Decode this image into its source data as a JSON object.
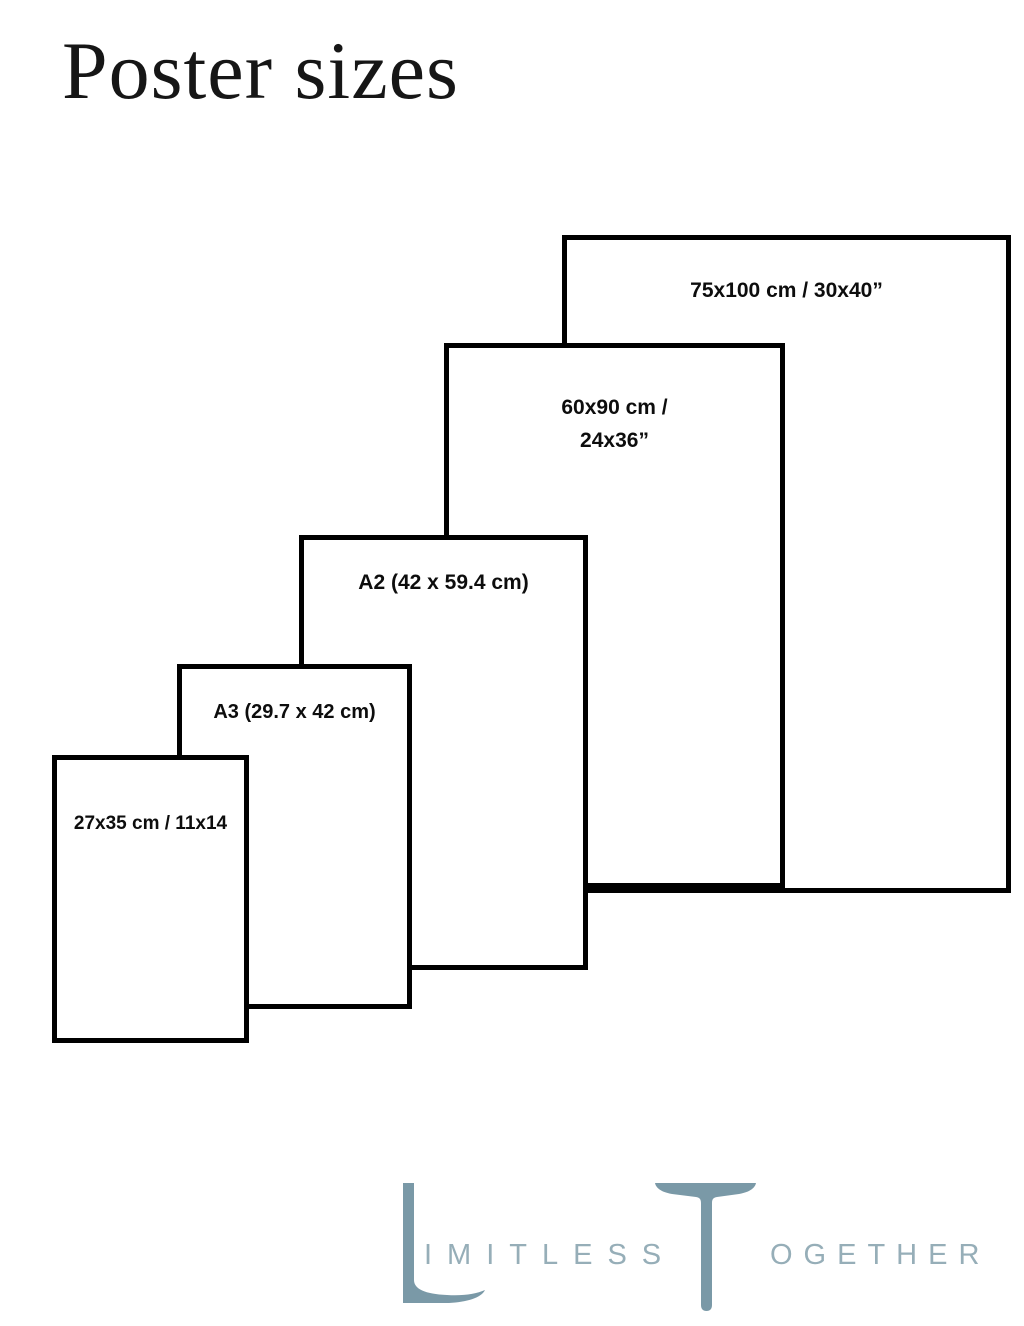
{
  "title": "Poster sizes",
  "posters": [
    {
      "name": "75x100",
      "label": "75x100 cm / 30x40”"
    },
    {
      "name": "60x90",
      "label_line1": "60x90 cm /",
      "label_line2": "24x36”"
    },
    {
      "name": "A2",
      "label": "A2 (42 x 59.4 cm)"
    },
    {
      "name": "A3",
      "label": "A3 (29.7 x 42 cm)"
    },
    {
      "name": "27x35",
      "label": "27x35 cm / 11x14"
    }
  ],
  "logo": {
    "word1_initial": "L",
    "word1_rest": "IMITLESS",
    "word2_initial": "T",
    "word2_rest": "OGETHER",
    "accent_color": "#7A99A7",
    "light_color": "#96AEB8"
  },
  "colors": {
    "background": "#FFFFFF",
    "rect_border": "#000000",
    "label_text": "#0D0D0D",
    "title_text": "#161616"
  }
}
